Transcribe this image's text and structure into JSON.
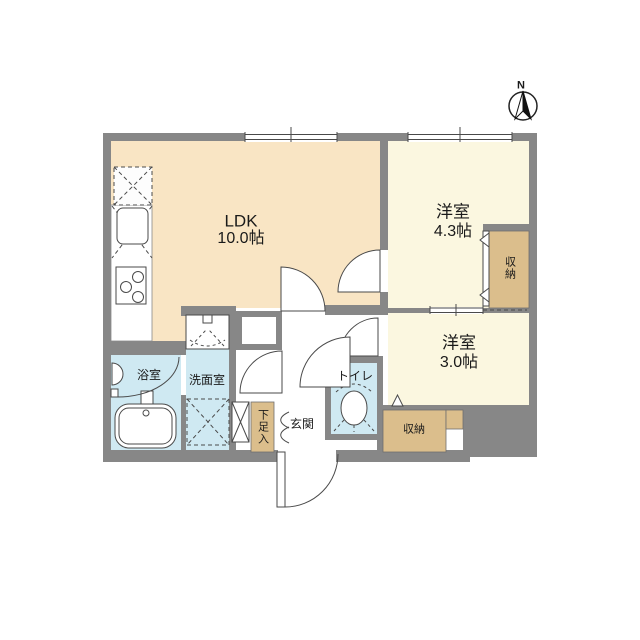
{
  "compass": {
    "north_label": "N"
  },
  "rooms": {
    "ldk": {
      "label": "LDK",
      "area": "10.0帖"
    },
    "western_room_1": {
      "label": "洋室",
      "area": "4.3帖"
    },
    "western_room_2": {
      "label": "洋室",
      "area": "3.0帖"
    },
    "bathroom": {
      "label": "浴室"
    },
    "washroom": {
      "label": "洗面室"
    },
    "toilet": {
      "label": "トイレ"
    },
    "entrance": {
      "label": "玄関"
    },
    "shoe_cabinet": {
      "label": "下足入"
    },
    "closet_right": {
      "label": "収納"
    },
    "closet_bottom": {
      "label": "収納"
    }
  },
  "colors": {
    "wall": "#878787",
    "ldk_floor": "#f9e5c4",
    "bedroom_floor": "#fbf7e0",
    "wet_area_floor": "#cfe9f2",
    "closet_floor": "#dbbe8c",
    "line": "#4a4a4a",
    "background": "#ffffff"
  }
}
